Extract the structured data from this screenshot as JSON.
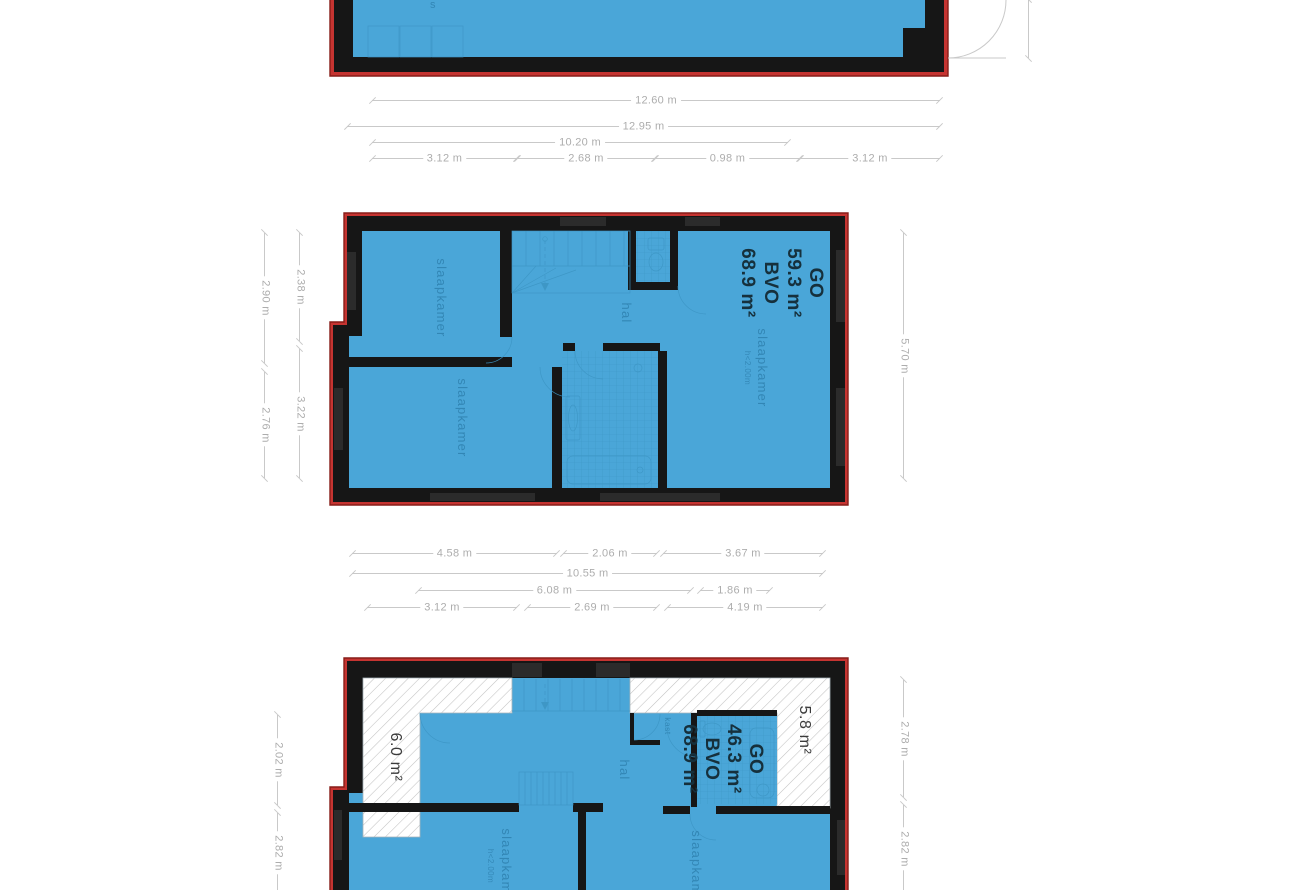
{
  "colors": {
    "room_fill": "#4AA6D8",
    "wall": "#161616",
    "outline": "#C53431",
    "outline_edge": "#871D18",
    "detail_line": "#3D96C5",
    "tile_line": "#3E98C6",
    "hatch_line": "#C2C2C2",
    "hatch_edge": "#A8B4BA",
    "window": "#2B2B2B",
    "dim_line": "#C9C9C9",
    "dim_text": "#ADADAD",
    "room_label": "#2D7FAD",
    "area_label": "#16303C",
    "zone_label": "#3A3A3A"
  },
  "plans": {
    "top": {
      "fragment": "s"
    },
    "middle": {
      "area_label": {
        "l1": "GO",
        "l2": "59.3 m²",
        "l3": "BVO",
        "l4": "68.9 m²"
      },
      "rooms": {
        "bedroom_top_left": "slaapkamer",
        "bedroom_bottom_left": "slaapkamer",
        "hall": "hal",
        "bedroom_right": "slaapkamer",
        "bedroom_right_note": "h<2.00m"
      }
    },
    "bottom": {
      "area_label": {
        "l1": "GO",
        "l2": "46.3 m²",
        "l3": "BVO",
        "l4": "68.9 m²"
      },
      "rooms": {
        "hall": "hal",
        "closet": "kast",
        "bedroom_left": "slaapkamer",
        "bedroom_left_note": "h<2.00m",
        "bedroom_right": "slaapkamer"
      },
      "zones": {
        "left": "6.0 m²",
        "right": "5.8 m²"
      }
    }
  },
  "dims": {
    "t1": "12.60 m",
    "t2": "12.95 m",
    "t3": "10.20 m",
    "t4a": "3.12 m",
    "t4b": "2.68 m",
    "t4c": "0.98 m",
    "t4d": "3.12 m",
    "m1a": "4.58 m",
    "m1b": "2.06 m",
    "m1c": "3.67 m",
    "m2": "10.55 m",
    "m3a": "6.08 m",
    "m3b": "1.86 m",
    "m4a": "3.12 m",
    "m4b": "2.69 m",
    "m4c": "4.19 m",
    "ml_outer_top": "2.90 m",
    "ml_outer_bottom": "2.76 m",
    "ml_inner_top": "2.38 m",
    "ml_inner_bottom": "3.22 m",
    "mr": "5.70 m",
    "bl_top": "2.02 m",
    "bl_bottom": "2.82 m",
    "br_top": "2.78 m",
    "br_bottom": "2.82 m"
  }
}
